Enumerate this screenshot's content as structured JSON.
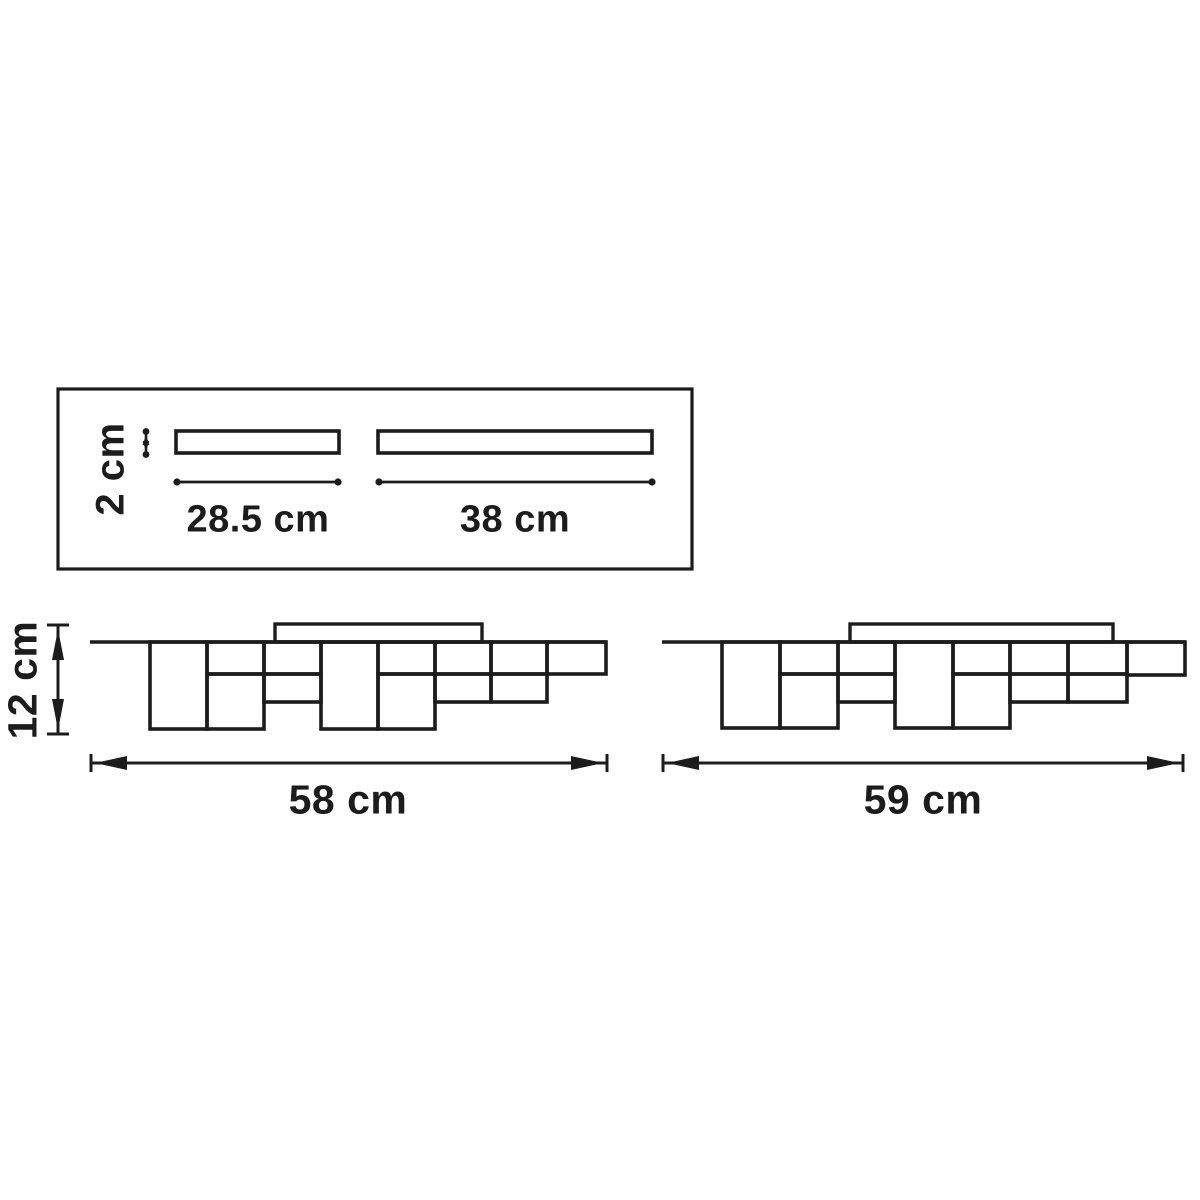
{
  "page": {
    "background": "#ffffff",
    "line_color": "#1c1c1c"
  },
  "top_view": {
    "bar_height_label": "2 cm",
    "bar1_length_label": "28.5 cm",
    "bar2_length_label": "38 cm"
  },
  "left_side_view": {
    "height_label": "12 cm",
    "width_label": "58 cm"
  },
  "right_side_view": {
    "width_label": "59 cm"
  }
}
